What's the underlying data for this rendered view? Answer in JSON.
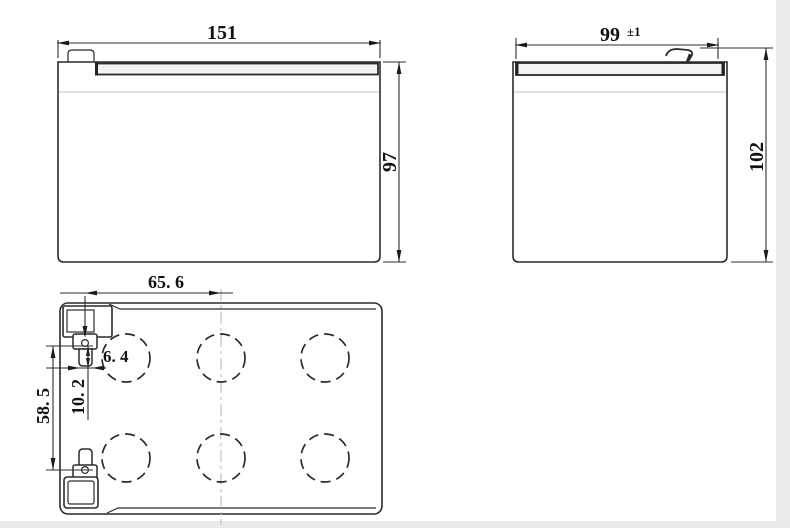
{
  "drawing": {
    "type": "battery-outline-dimension-drawing",
    "units_implied": "mm",
    "colors": {
      "line": "#2b2b2b",
      "dimension_line": "#2e2e2e",
      "faint_line": "#c7c7c7",
      "band_fill": "#f2f2f2",
      "scan_edge": "#ececec",
      "text": "#111111",
      "background": "#ffffff"
    },
    "views": {
      "front": {
        "name": "front view",
        "width": {
          "label": "151"
        },
        "height": {
          "label": "97"
        }
      },
      "side": {
        "name": "side view",
        "depth": {
          "label": "99",
          "tolerance": "±1"
        },
        "overall_height": {
          "label": "102"
        }
      },
      "top": {
        "name": "top view",
        "vent_circle_count": 6,
        "terminal_pitch": {
          "label": "65. 6"
        },
        "terminal_width": {
          "label": "6. 4"
        },
        "terminal_offset": {
          "label": "10. 2"
        },
        "terminal_span": {
          "label": "58. 5"
        }
      }
    }
  }
}
